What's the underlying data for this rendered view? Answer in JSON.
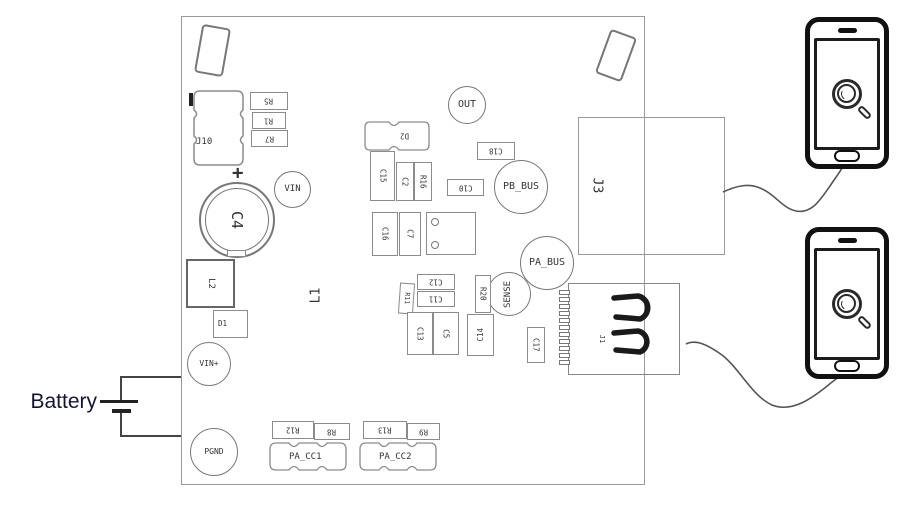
{
  "battery": {
    "label": "Battery"
  },
  "board": {
    "polarity_mark": "+",
    "connectors": {
      "j10": "J10",
      "j3": "J3",
      "j1": "J1"
    },
    "test_points": {
      "vin": "VIN",
      "out": "OUT",
      "pb_bus": "PB_BUS",
      "pa_bus": "PA_BUS",
      "sense": "SENSE",
      "vin_plus": "VIN+",
      "pgnd": "PGND"
    },
    "capacitors": {
      "c2": "C2",
      "c4": "C4",
      "c5": "C5",
      "c7": "C7",
      "c10": "C10",
      "c11": "C11",
      "c12": "C12",
      "c13": "C13",
      "c14": "C14",
      "c15": "C15",
      "c16": "C16",
      "c17": "C17",
      "c18": "C18"
    },
    "resistors": {
      "r1": "R1",
      "r5": "R5",
      "r7": "R7",
      "r8": "R8",
      "r9": "R9",
      "r11": "R11",
      "r12": "R12",
      "r13": "R13",
      "r16": "R16",
      "r20": "R20"
    },
    "inductors": {
      "l1": "L1",
      "l2": "L2"
    },
    "diodes": {
      "d1": "D1",
      "d2": "D2"
    },
    "pads": {
      "pa_cc1": "PA_CC1",
      "pa_cc2": "PA_CC2"
    }
  },
  "phones": {
    "screen_icon": "magnifier-icon",
    "count": 2
  },
  "colors": {
    "board_outline": "#9a9a9a",
    "component_outline": "#8c8c8c",
    "label_text": "#333333",
    "phone_outline": "#111111",
    "wire": "#555555",
    "battery_text": "#14143a"
  }
}
